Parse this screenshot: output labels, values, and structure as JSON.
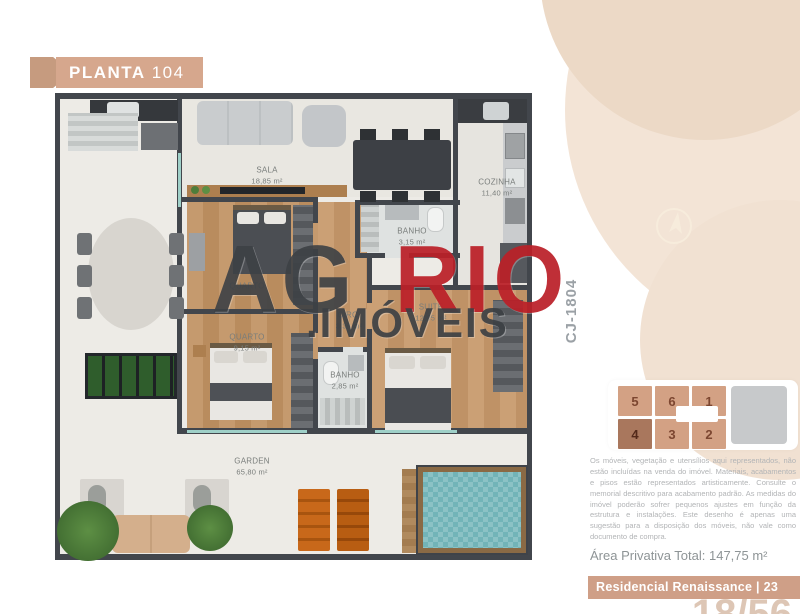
{
  "header": {
    "ribbon_bold": "PLANTA",
    "ribbon_number": "104"
  },
  "watermark": {
    "part1": "AG",
    "part2": "RIO",
    "part3": ".IMÓVEIS"
  },
  "floorplan": {
    "unit_code": "CJ-1804",
    "rooms": {
      "sala": {
        "name": "SALA",
        "area": "18,85 m²"
      },
      "cozinha": {
        "name": "COZINHA",
        "area": "11,40 m²"
      },
      "banho1": {
        "name": "BANHO",
        "area": "3,15 m²"
      },
      "quarto1": {
        "name": "QUARTO",
        "area": ""
      },
      "quarto2": {
        "name": "QUARTO",
        "area": "9,15 m²"
      },
      "circ": {
        "name": "CIRC.",
        "area": "3,36 m²"
      },
      "suite": {
        "name": "SUITE",
        "area": "12,05 m²"
      },
      "banho2": {
        "name": "BANHO",
        "area": "2,85 m²"
      },
      "garden": {
        "name": "GARDEN",
        "area": "65,80 m²"
      }
    }
  },
  "keyplan": {
    "units": [
      "5",
      "6",
      "1",
      "4",
      "3",
      "2"
    ],
    "highlighted_unit": "4"
  },
  "sidebar": {
    "disclaimer": "Os móveis, vegetação e utensílios aqui representados, não estão incluídas na venda do imóvel. Materiais, acabamentos e pisos estão representados artisticamente. Consulte o memorial descritivo para acabamento padrão. As medidas do imóvel poderão sofrer pequenos ajustes em função da estrutura e instalações. Este desenho é apenas uma sugestão para a disposição dos móveis, não vale como documento de compra.",
    "area_total": "Área Privativa Total: 147,75 m²",
    "footer": "Residencial Renaissance | 23",
    "page": "18/56"
  },
  "colors": {
    "accent_tan": "#d6a78d",
    "watermark_red": "#bb2028",
    "pool": "#72b4b8"
  }
}
